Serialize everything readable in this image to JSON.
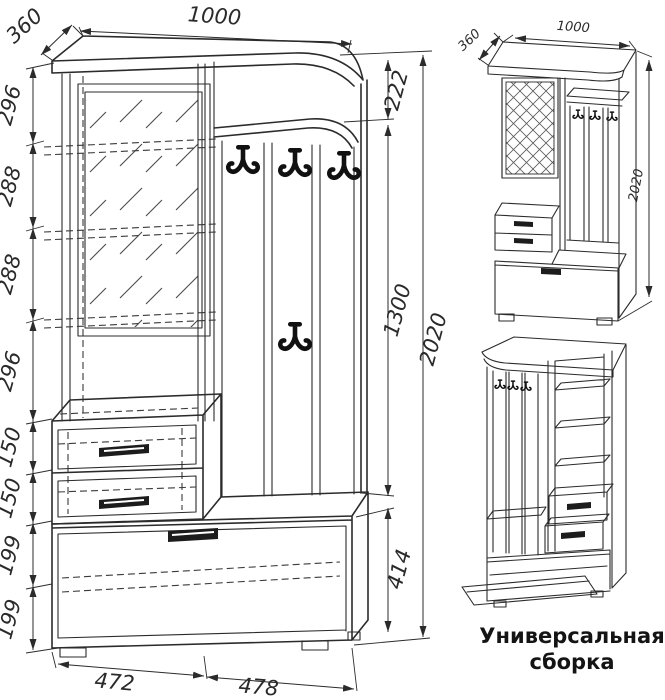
{
  "front_view": {
    "width_top": "1000",
    "depth": "360",
    "heights_left": [
      "296",
      "288",
      "288",
      "296",
      "150",
      "150",
      "199",
      "199"
    ],
    "height_niche": "222",
    "height_panel": "1300",
    "height_cabinet": "414",
    "height_total": "2020",
    "width_bottom_left": "472",
    "width_bottom_right": "478"
  },
  "iso_view": {
    "depth": "360",
    "width": "1000",
    "height": "2020"
  },
  "caption": {
    "line1": "Универсальная",
    "line2": "сборка"
  }
}
